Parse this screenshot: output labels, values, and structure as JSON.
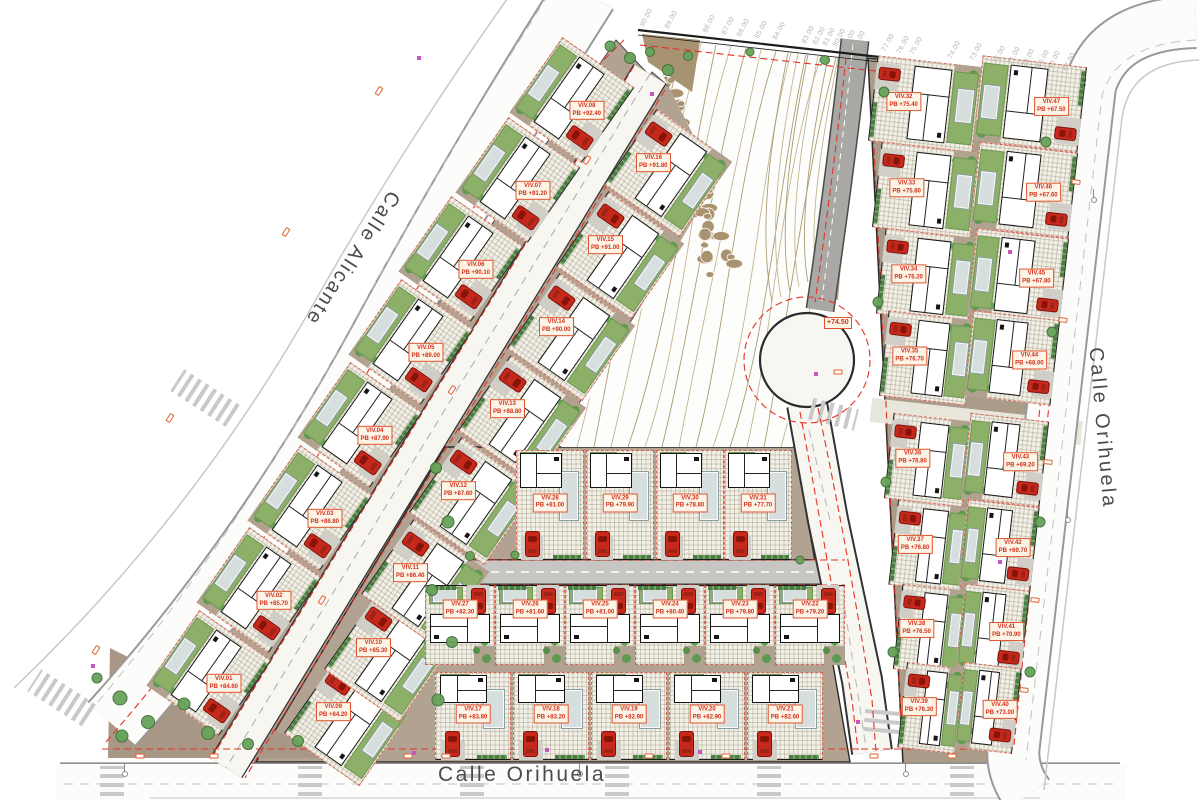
{
  "plan": {
    "streets": {
      "alicante": "Calle Alicante",
      "orihuela_right": "Calle Orihuela",
      "orihuela_bottom": "Calle Orihuela"
    },
    "roundabout_label": "+74.50"
  },
  "elevation_marks": [
    {
      "v": "90.00",
      "x": 645
    },
    {
      "v": "89.00",
      "x": 670
    },
    {
      "v": "88.00",
      "x": 708
    },
    {
      "v": "87.00",
      "x": 727
    },
    {
      "v": "86.00",
      "x": 742
    },
    {
      "v": "85.00",
      "x": 760
    },
    {
      "v": "84.00",
      "x": 778
    },
    {
      "v": "83.00",
      "x": 807
    },
    {
      "v": "82.00",
      "x": 818
    },
    {
      "v": "81.00",
      "x": 828
    },
    {
      "v": "80.00",
      "x": 838
    },
    {
      "v": "79.00",
      "x": 848
    },
    {
      "v": "78.00",
      "x": 858
    },
    {
      "v": "77.00",
      "x": 887
    },
    {
      "v": "76.00",
      "x": 902
    },
    {
      "v": "75.00",
      "x": 915
    },
    {
      "v": "74.00",
      "x": 953
    },
    {
      "v": "73.00",
      "x": 975
    },
    {
      "v": "72.00",
      "x": 998
    },
    {
      "v": "71.00",
      "x": 1013
    },
    {
      "v": "70.00",
      "x": 1027
    },
    {
      "v": "69.00",
      "x": 1042
    },
    {
      "v": "68.00",
      "x": 1053
    },
    {
      "v": "67.00",
      "x": 1068
    }
  ],
  "blocks": {
    "left-upper": {
      "w": 92,
      "h": 88,
      "r": -55
    },
    "left-lower": {
      "w": 92,
      "h": 92,
      "r": 125
    },
    "middle-a": {
      "w": 68,
      "h": 110,
      "r": 0
    },
    "middle-b": {
      "w": 70,
      "h": 80,
      "r": 180
    },
    "middle-c": {
      "w": 76,
      "h": 88,
      "r": 0
    },
    "right-west": {
      "w": 86,
      "h": 90,
      "r": 96.5
    },
    "right-east": {
      "w": 86,
      "h": 90,
      "r": -83.5
    }
  },
  "villas": [
    {
      "n": "VIV.01",
      "l": "PB +84.60",
      "x": 209,
      "y": 673,
      "b": "left-upper"
    },
    {
      "n": "VIV.02",
      "l": "PB +85.70",
      "x": 259,
      "y": 590,
      "b": "left-upper"
    },
    {
      "n": "VIV.03",
      "l": "PB +86.80",
      "x": 310,
      "y": 508,
      "b": "left-upper"
    },
    {
      "n": "VIV.04",
      "l": "PB +87.90",
      "x": 360,
      "y": 425,
      "b": "left-upper"
    },
    {
      "n": "VIV.05",
      "l": "PB +89.00",
      "x": 411,
      "y": 342,
      "b": "left-upper"
    },
    {
      "n": "VIV.06",
      "l": "PB +90.10",
      "x": 461,
      "y": 259,
      "b": "left-upper"
    },
    {
      "n": "VIV.07",
      "l": "PB +91.20",
      "x": 518,
      "y": 180,
      "b": "left-upper"
    },
    {
      "n": "VIV.08",
      "l": "PB +92.40",
      "x": 572,
      "y": 100,
      "b": "left-upper"
    },
    {
      "n": "VIV.09",
      "l": "PB +84.20",
      "x": 348,
      "y": 722,
      "b": "left-lower"
    },
    {
      "n": "VIV.10",
      "l": "PB +85.30",
      "x": 388,
      "y": 658,
      "b": "left-lower"
    },
    {
      "n": "VIV.11",
      "l": "PB +86.40",
      "x": 425,
      "y": 583,
      "b": "left-lower"
    },
    {
      "n": "VIV.12",
      "l": "PB +87.60",
      "x": 473,
      "y": 501,
      "b": "left-lower"
    },
    {
      "n": "VIV.13",
      "l": "PB +88.80",
      "x": 522,
      "y": 419,
      "b": "left-lower"
    },
    {
      "n": "VIV.14",
      "l": "PB +90.00",
      "x": 571,
      "y": 337,
      "b": "left-lower"
    },
    {
      "n": "VIV.15",
      "l": "PB +91.00",
      "x": 620,
      "y": 255,
      "b": "left-lower"
    },
    {
      "n": "VIV.16",
      "l": "PB +91.80",
      "x": 668,
      "y": 173,
      "b": "left-lower"
    },
    {
      "n": "VIV.17",
      "l": "PB +83.80",
      "x": 473,
      "y": 716,
      "b": "middle-c"
    },
    {
      "n": "VIV.18",
      "l": "PB +83.20",
      "x": 551,
      "y": 716,
      "b": "middle-c"
    },
    {
      "n": "VIV.19",
      "l": "PB +82.90",
      "x": 629,
      "y": 716,
      "b": "middle-c"
    },
    {
      "n": "VIV.20",
      "l": "PB +82.90",
      "x": 707,
      "y": 716,
      "b": "middle-c"
    },
    {
      "n": "VIV.21",
      "l": "PB +82.60",
      "x": 785,
      "y": 716,
      "b": "middle-c"
    },
    {
      "n": "VIV.27",
      "l": "PB +82.30",
      "x": 460,
      "y": 625,
      "b": "middle-b"
    },
    {
      "n": "VIV.26",
      "l": "PB +81.60",
      "x": 530,
      "y": 625,
      "b": "middle-b"
    },
    {
      "n": "VIV.25",
      "l": "PB +81.00",
      "x": 600,
      "y": 625,
      "b": "middle-b"
    },
    {
      "n": "VIV.24",
      "l": "PB +80.40",
      "x": 670,
      "y": 625,
      "b": "middle-b"
    },
    {
      "n": "VIV.23",
      "l": "PB +79.80",
      "x": 740,
      "y": 625,
      "b": "middle-b"
    },
    {
      "n": "VIV.22",
      "l": "PB +79.20",
      "x": 810,
      "y": 625,
      "b": "middle-b"
    },
    {
      "n": "VIV.28",
      "l": "PB +81.00",
      "x": 550,
      "y": 505,
      "b": "middle-a"
    },
    {
      "n": "VIV.29",
      "l": "PB +79.90",
      "x": 620,
      "y": 505,
      "b": "middle-a"
    },
    {
      "n": "VIV.30",
      "l": "PB +78.80",
      "x": 690,
      "y": 505,
      "b": "middle-a"
    },
    {
      "n": "VIV.31",
      "l": "PB +77.70",
      "x": 758,
      "y": 505,
      "b": "middle-a"
    },
    {
      "n": "VIV.32",
      "l": "PB +75.40",
      "x": 925,
      "y": 104,
      "h": 105,
      "b": "right-west"
    },
    {
      "n": "VIV.33",
      "l": "PB +75.80",
      "x": 926,
      "y": 190,
      "h": 99,
      "b": "right-west"
    },
    {
      "n": "VIV.34",
      "l": "PB +76.20",
      "x": 927,
      "y": 276,
      "h": 93,
      "b": "right-west"
    },
    {
      "n": "VIV.35",
      "l": "PB +76.70",
      "x": 927,
      "y": 358,
      "h": 87,
      "b": "right-west"
    },
    {
      "n": "VIV.36",
      "l": "PB +76.80",
      "x": 928,
      "y": 460,
      "h": 79,
      "b": "right-west"
    },
    {
      "n": "VIV.37",
      "l": "PB +76.80",
      "x": 929,
      "y": 546,
      "h": 72,
      "b": "right-west"
    },
    {
      "n": "VIV.38",
      "l": "PB +76.50",
      "x": 930,
      "y": 630,
      "h": 65,
      "b": "right-west"
    },
    {
      "n": "VIV.39",
      "l": "PB +76.30",
      "x": 931,
      "y": 708,
      "h": 58,
      "b": "right-west"
    },
    {
      "n": "VIV.47",
      "l": "PB +67.50",
      "x": 1030,
      "y": 104,
      "h": 105,
      "b": "right-east"
    },
    {
      "n": "VIV.46",
      "l": "PB +67.60",
      "x": 1024,
      "y": 190,
      "h": 99,
      "b": "right-east"
    },
    {
      "n": "VIV.45",
      "l": "PB +67.80",
      "x": 1018,
      "y": 276,
      "h": 93,
      "b": "right-east"
    },
    {
      "n": "VIV.44",
      "l": "PB +68.00",
      "x": 1012,
      "y": 358,
      "h": 87,
      "b": "right-east"
    },
    {
      "n": "VIV.43",
      "l": "PB +69.20",
      "x": 1005,
      "y": 460,
      "h": 79,
      "b": "right-east"
    },
    {
      "n": "VIV.42",
      "l": "PB +69.70",
      "x": 999,
      "y": 546,
      "h": 72,
      "b": "right-east"
    },
    {
      "n": "VIV.41",
      "l": "PB +70.90",
      "x": 993,
      "y": 630,
      "h": 65,
      "b": "right-east"
    },
    {
      "n": "VIV.40",
      "l": "PB +73.00",
      "x": 988,
      "y": 708,
      "h": 58,
      "b": "right-east"
    }
  ],
  "landscape": {
    "trees": [
      [
        610,
        46,
        11
      ],
      [
        630,
        58,
        12
      ],
      [
        650,
        52,
        10
      ],
      [
        668,
        70,
        12
      ],
      [
        688,
        56,
        10
      ],
      [
        750,
        52,
        9
      ],
      [
        825,
        60,
        10
      ],
      [
        120,
        698,
        15
      ],
      [
        148,
        722,
        14
      ],
      [
        184,
        704,
        13
      ],
      [
        122,
        736,
        13
      ],
      [
        208,
        733,
        14
      ],
      [
        248,
        744,
        12
      ],
      [
        97,
        678,
        11
      ],
      [
        298,
        741,
        12
      ],
      [
        436,
        468,
        12
      ],
      [
        448,
        522,
        13
      ],
      [
        432,
        590,
        12
      ],
      [
        452,
        642,
        12
      ],
      [
        438,
        700,
        13
      ],
      [
        470,
        556,
        10
      ],
      [
        515,
        555,
        9
      ],
      [
        800,
        560,
        9
      ],
      [
        884,
        92,
        11
      ],
      [
        1046,
        142,
        11
      ],
      [
        878,
        302,
        11
      ],
      [
        1052,
        332,
        11
      ],
      [
        886,
        482,
        11
      ],
      [
        1040,
        522,
        11
      ],
      [
        893,
        652,
        11
      ],
      [
        1030,
        672,
        11
      ]
    ]
  },
  "site_furniture": {
    "streetlights": [
      [
        140,
        756,
        0
      ],
      [
        214,
        756,
        0
      ],
      [
        408,
        756,
        0
      ],
      [
        446,
        756,
        0
      ],
      [
        649,
        756,
        0
      ],
      [
        726,
        756,
        0
      ],
      [
        874,
        756,
        0
      ],
      [
        952,
        756,
        0
      ],
      [
        96,
        650,
        -57
      ],
      [
        170,
        418,
        -57
      ],
      [
        286,
        232,
        -57
      ],
      [
        379,
        91,
        -57
      ],
      [
        1076,
        182,
        6
      ],
      [
        1063,
        320,
        6
      ],
      [
        1048,
        462,
        6
      ],
      [
        1035,
        600,
        6
      ],
      [
        1024,
        690,
        6
      ],
      [
        587,
        160,
        -57
      ],
      [
        452,
        390,
        -57
      ],
      [
        322,
        600,
        -57
      ],
      [
        838,
        372,
        0
      ]
    ],
    "utilities": [
      [
        93,
        666
      ],
      [
        419,
        58
      ],
      [
        652,
        94
      ],
      [
        816,
        374
      ],
      [
        858,
        722
      ],
      [
        414,
        753
      ],
      [
        1010,
        252
      ],
      [
        1000,
        562
      ],
      [
        547,
        750
      ],
      [
        700,
        752
      ]
    ],
    "lamps": [
      [
        125,
        774
      ],
      [
        580,
        774
      ],
      [
        906,
        774
      ],
      [
        1094,
        200
      ],
      [
        1068,
        520
      ]
    ]
  }
}
